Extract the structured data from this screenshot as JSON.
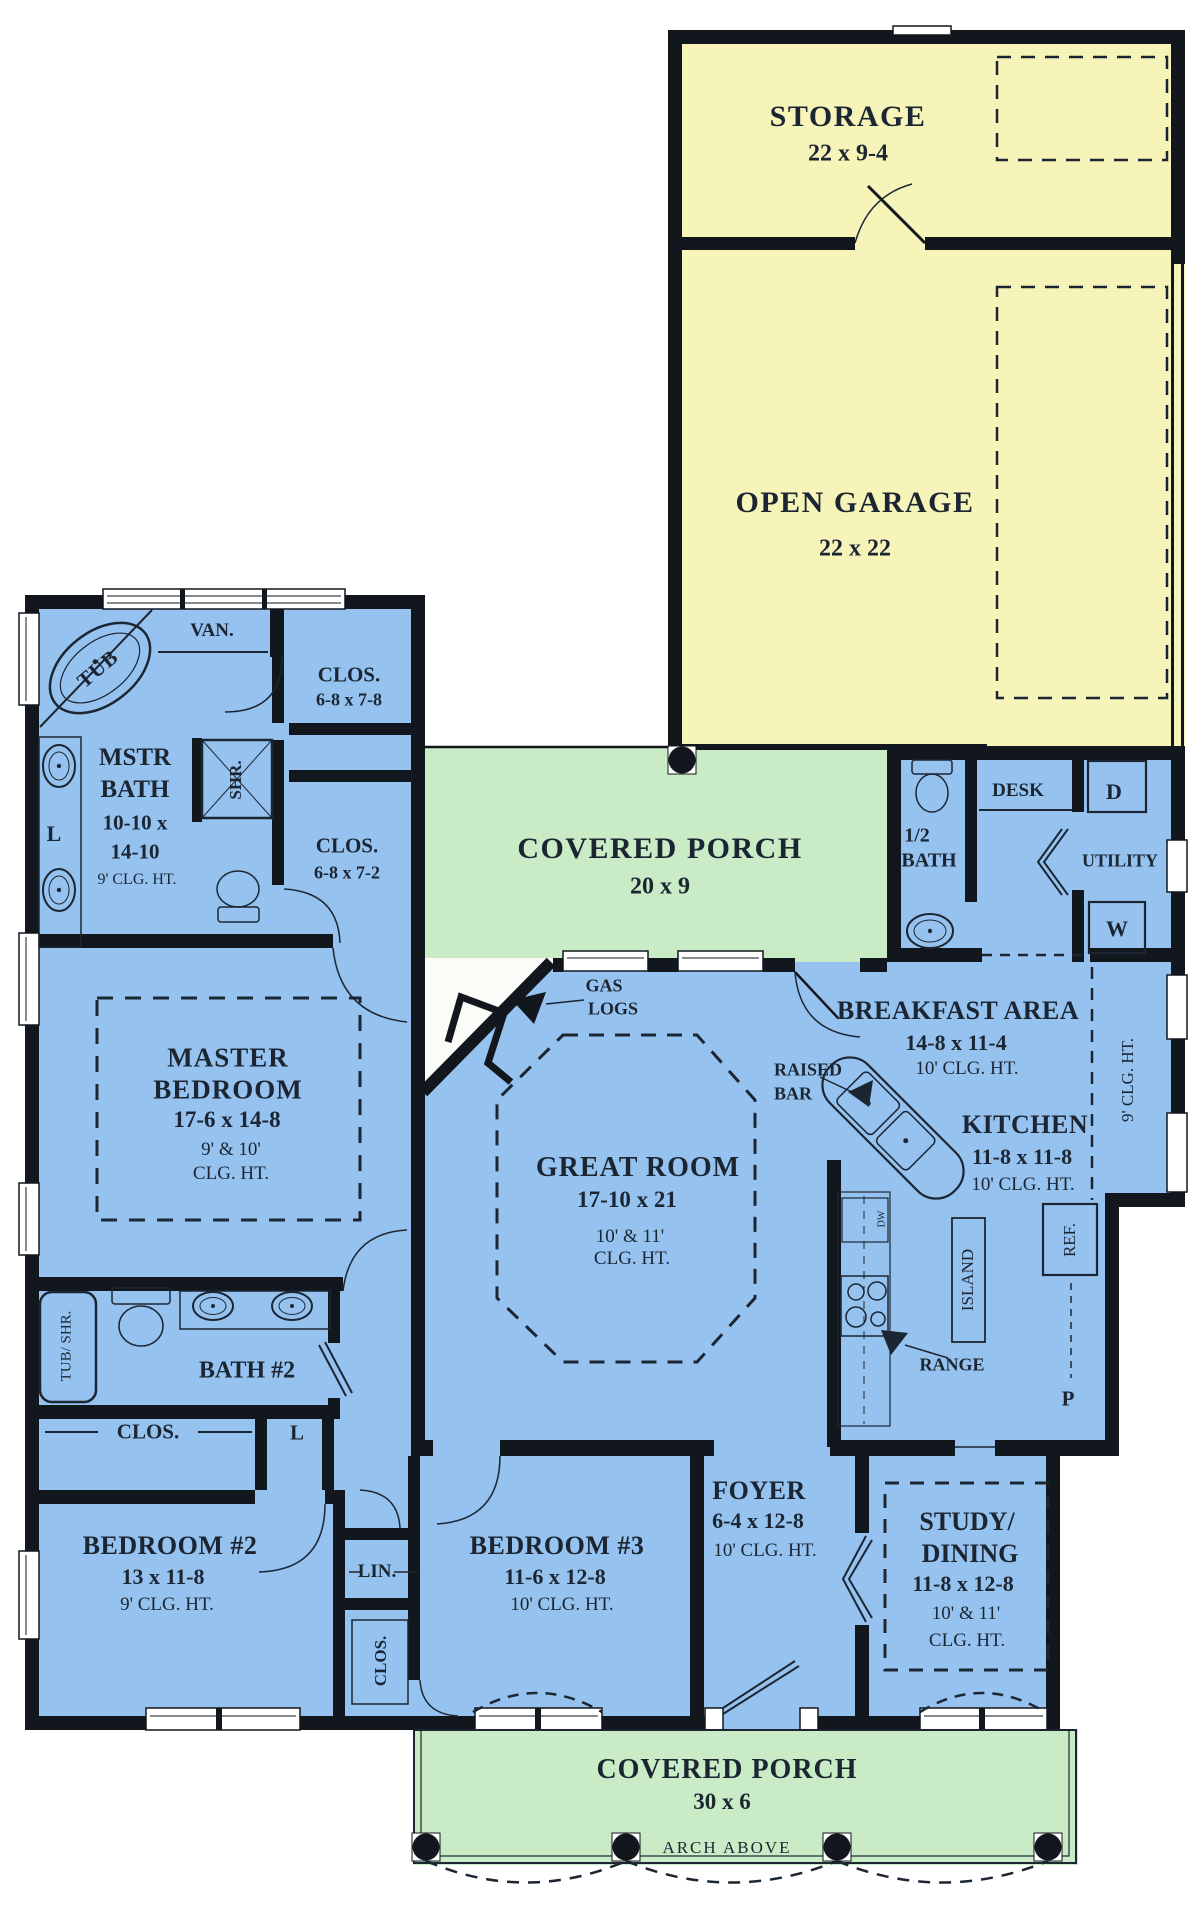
{
  "title": "House floor plan",
  "colors": {
    "room_blue": "#95c2ef",
    "garage_yellow": "#f7f4ba",
    "porch_green": "#c9ebc5",
    "wall_black": "#12171d",
    "text": "#1c2633",
    "background": "#ffffff"
  },
  "rooms": {
    "storage": {
      "name": "STORAGE",
      "dims": "22 x 9-4"
    },
    "open_garage": {
      "name": "OPEN GARAGE",
      "dims": "22 x 22"
    },
    "rear_porch": {
      "name": "COVERED PORCH",
      "dims": "20 x 9"
    },
    "master_bath": {
      "name1": "MSTR",
      "name2": "BATH",
      "dims1": "10-10 x",
      "dims2": "14-10",
      "ceiling": "9' CLG. HT.",
      "tub": "TUB",
      "vanity": "VAN.",
      "shower": "SHR.",
      "linen": "L"
    },
    "closet1": {
      "name": "CLOS.",
      "dims": "6-8 x 7-8"
    },
    "closet2": {
      "name": "CLOS.",
      "dims": "6-8 x 7-2"
    },
    "half_bath": {
      "name1": "1/2",
      "name2": "BATH"
    },
    "utility": {
      "name": "UTILITY",
      "desk": "DESK",
      "dryer": "D",
      "washer": "W"
    },
    "master_bedroom": {
      "name1": "MASTER",
      "name2": "BEDROOM",
      "dims": "17-6 x 14-8",
      "ceiling1": "9' & 10'",
      "ceiling2": "CLG. HT."
    },
    "great_room": {
      "name": "GREAT ROOM",
      "dims": "17-10 x 21",
      "ceiling1": "10' & 11'",
      "ceiling2": "CLG. HT.",
      "gas1": "GAS",
      "gas2": "LOGS"
    },
    "breakfast": {
      "name": "BREAKFAST AREA",
      "dims": "14-8 x 11-4",
      "ceiling": "10' CLG. HT."
    },
    "kitchen": {
      "name": "KITCHEN",
      "dims": "11-8 x 11-8",
      "ceiling": "10' CLG. HT.",
      "island": "ISLAND",
      "range": "RANGE",
      "refrigerator": "REF.",
      "pantry": "P",
      "dishwasher": "DW",
      "raised1": "RAISED",
      "raised2": "BAR",
      "side_ceiling": "9' CLG. HT."
    },
    "bath2": {
      "name": "BATH #2",
      "tub_shower": "TUB/ SHR.",
      "closet": "CLOS.",
      "linen": "L"
    },
    "bedroom2": {
      "name": "BEDROOM #2",
      "dims": "13 x 11-8",
      "ceiling": "9' CLG. HT."
    },
    "hall": {
      "linen": "LIN.",
      "closet": "CLOS."
    },
    "bedroom3": {
      "name": "BEDROOM #3",
      "dims": "11-6 x 12-8",
      "ceiling": "10' CLG. HT."
    },
    "foyer": {
      "name": "FOYER",
      "dims": "6-4 x 12-8",
      "ceiling": "10' CLG. HT."
    },
    "study": {
      "name1": "STUDY/",
      "name2": "DINING",
      "dims": "11-8 x 12-8",
      "ceiling1": "10' & 11'",
      "ceiling2": "CLG. HT."
    },
    "front_porch": {
      "name": "COVERED PORCH",
      "dims": "30 x 6",
      "note": "ARCH ABOVE"
    }
  }
}
